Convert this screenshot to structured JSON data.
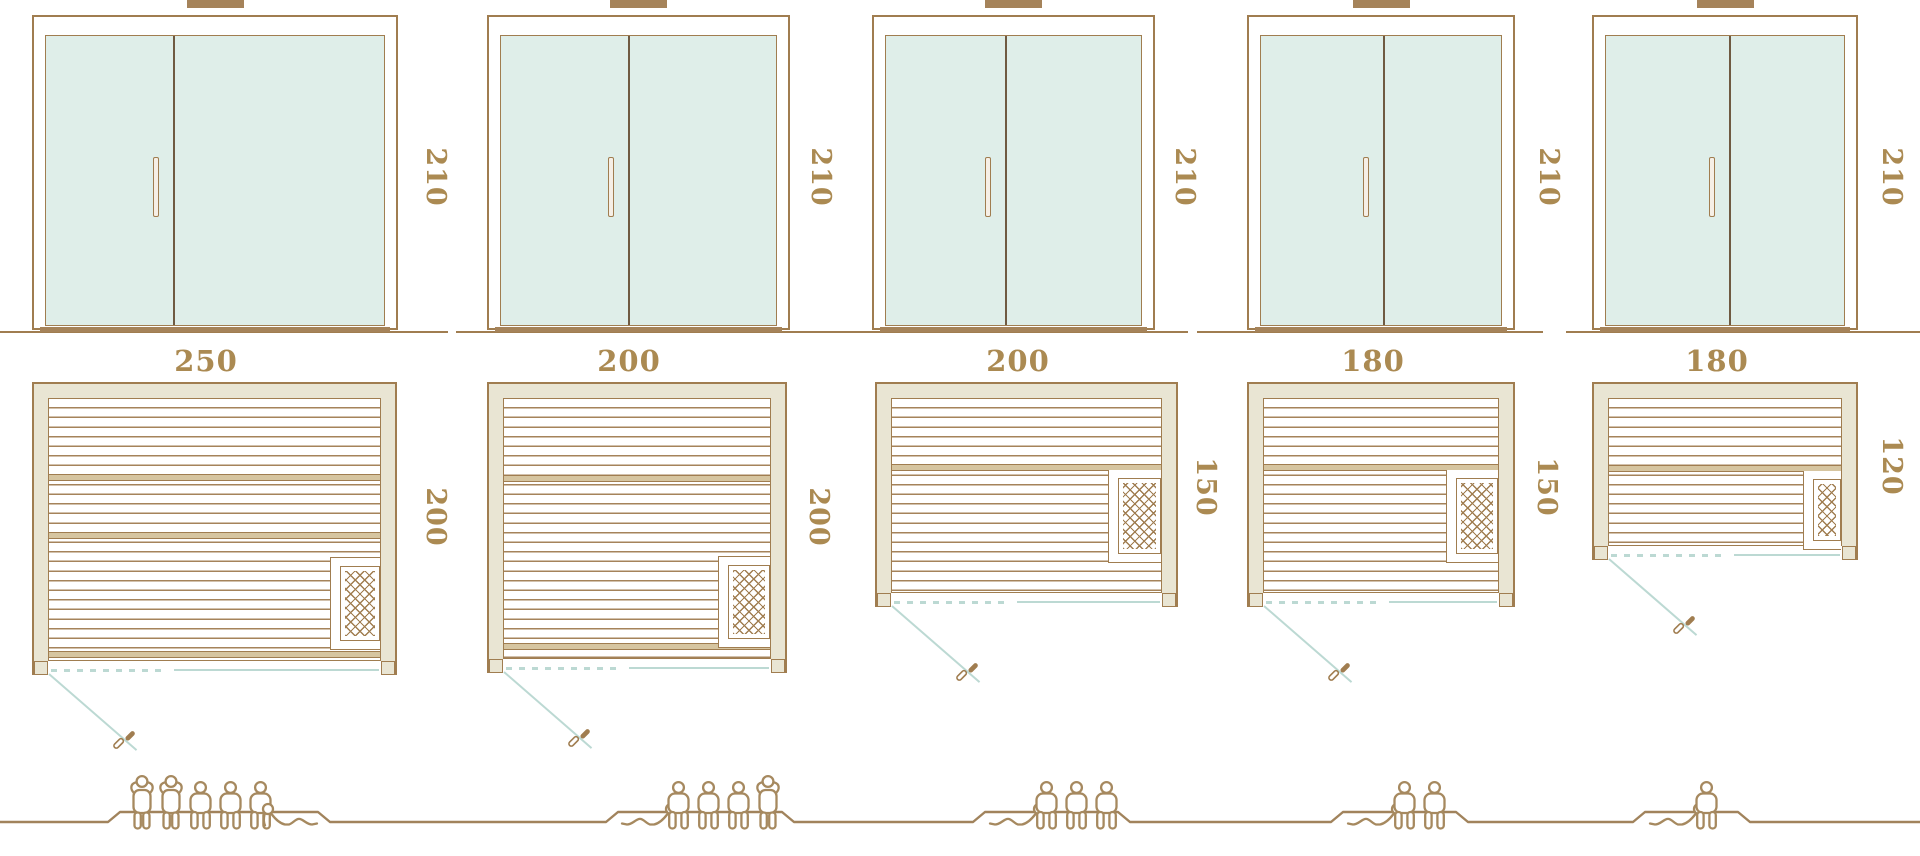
{
  "models": [
    {
      "id": "model-1",
      "door": {
        "height_label": "210"
      },
      "plan": {
        "width_label": "250",
        "depth_label": "200"
      },
      "capacity": {
        "count": 6,
        "figures": [
          "standing",
          "standing",
          "sitting",
          "sitting",
          "sitting",
          "reclining-mirrored"
        ]
      }
    },
    {
      "id": "model-2",
      "door": {
        "height_label": "210"
      },
      "plan": {
        "width_label": "200",
        "depth_label": "200"
      },
      "capacity": {
        "count": 5,
        "figures": [
          "reclining",
          "sitting",
          "sitting",
          "sitting",
          "standing"
        ]
      }
    },
    {
      "id": "model-3",
      "door": {
        "height_label": "210"
      },
      "plan": {
        "width_label": "200",
        "depth_label": "150"
      },
      "capacity": {
        "count": 4,
        "figures": [
          "reclining",
          "sitting",
          "sitting",
          "sitting"
        ]
      }
    },
    {
      "id": "model-4",
      "door": {
        "height_label": "210"
      },
      "plan": {
        "width_label": "180",
        "depth_label": "150"
      },
      "capacity": {
        "count": 3,
        "figures": [
          "reclining",
          "sitting",
          "sitting"
        ]
      }
    },
    {
      "id": "model-5",
      "door": {
        "height_label": "210"
      },
      "plan": {
        "width_label": "180",
        "depth_label": "120"
      },
      "capacity": {
        "count": 2,
        "figures": [
          "reclining",
          "sitting"
        ]
      }
    }
  ],
  "icons": {
    "heater": "heater-crosshatch-icon",
    "door_leaf": "open-door-leaf-icon",
    "figure_types": [
      "standing-person-icon",
      "sitting-person-icon",
      "reclining-person-icon"
    ]
  },
  "colors": {
    "line": "#a07d50",
    "label_text": "#ab8a52",
    "wall_fill": "#e9e5d3",
    "glass_fill": "#dfeee9",
    "door_swing": "#bcd9d3",
    "figure_outline": "#a6895f",
    "background": "#ffffff"
  }
}
